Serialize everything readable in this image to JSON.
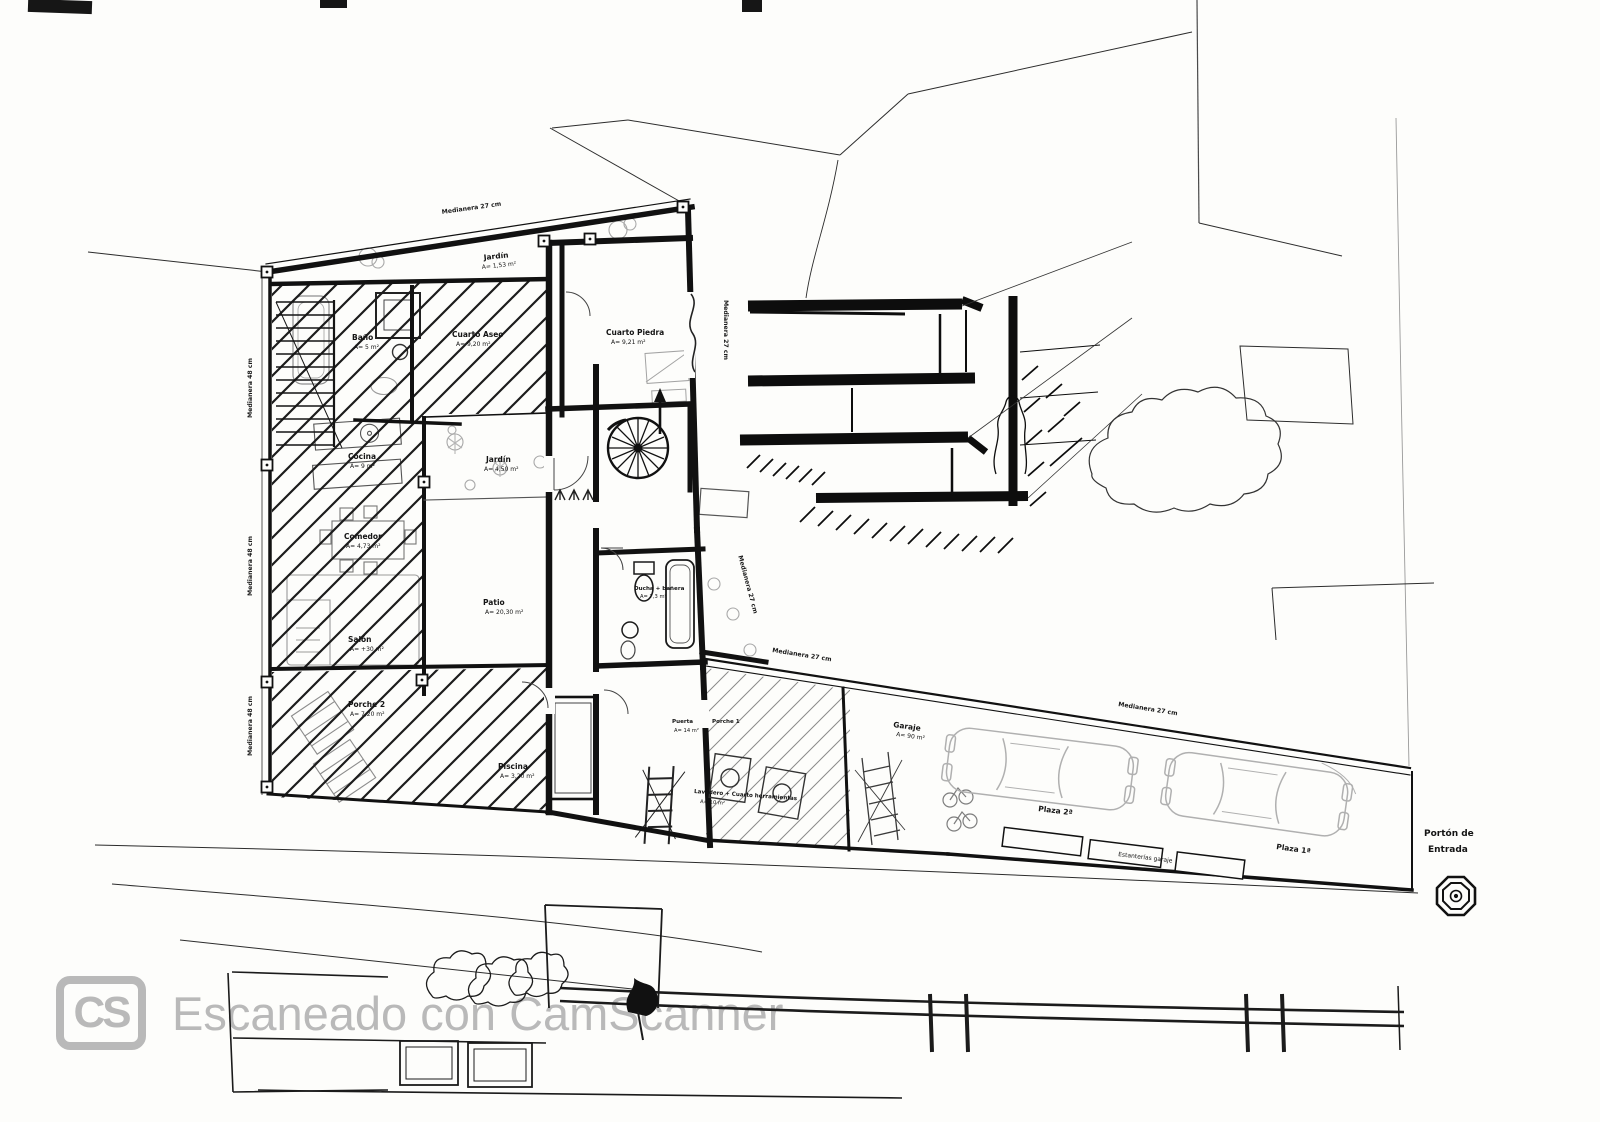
{
  "watermark": {
    "logo": "CS",
    "text": "Escaneado con CamScanner"
  },
  "boundary_labels": {
    "medianera_27": "Medianera 27 cm",
    "medianera_48": "Medianera 48 cm"
  },
  "rooms": {
    "jardin_top": {
      "name": "Jardín",
      "area": "A= 1,53 m²"
    },
    "bano": {
      "name": "Baño",
      "area": "A= 5 m²"
    },
    "cuarto_aseo": {
      "name": "Cuarto Aseo",
      "area": "A= 9,20 m²"
    },
    "cuarto_piedra": {
      "name": "Cuarto Piedra",
      "area": "A= 9,21 m²"
    },
    "cocina": {
      "name": "Cocina",
      "area": "A= 9 m²"
    },
    "jardin_patio": {
      "name": "Jardín",
      "area": "A= 4,50 m²"
    },
    "comedor": {
      "name": "Comedor",
      "area": "A= 4,73 m²"
    },
    "patio": {
      "name": "Patio",
      "area": "A= 20,30 m²"
    },
    "salon": {
      "name": "Salón",
      "area": "A= +30 m²"
    },
    "porche_2": {
      "name": "Porche 2",
      "area": "A= 7,20 m²"
    },
    "piscina": {
      "name": "Piscina",
      "area": "A= 3,20 m²"
    },
    "ducha": {
      "name": "Ducha + bañera",
      "area": "A= 7,3 m²"
    },
    "puerta": {
      "name": "Puerta",
      "area": "A= 14 m²"
    },
    "porche_1": {
      "name": "Porche 1"
    },
    "lavadero": {
      "name": "Lavadero + Cuarto herramientas",
      "area": "A= 10 m²"
    },
    "garaje": {
      "name": "Garaje",
      "area": "A= 90 m²"
    }
  },
  "garage": {
    "plaza_1": "Plaza 1ª",
    "plaza_2": "Plaza 2ª",
    "estanterias": "Estanterías garaje",
    "porton_line1": "Portón de",
    "porton_line2": "Entrada"
  }
}
